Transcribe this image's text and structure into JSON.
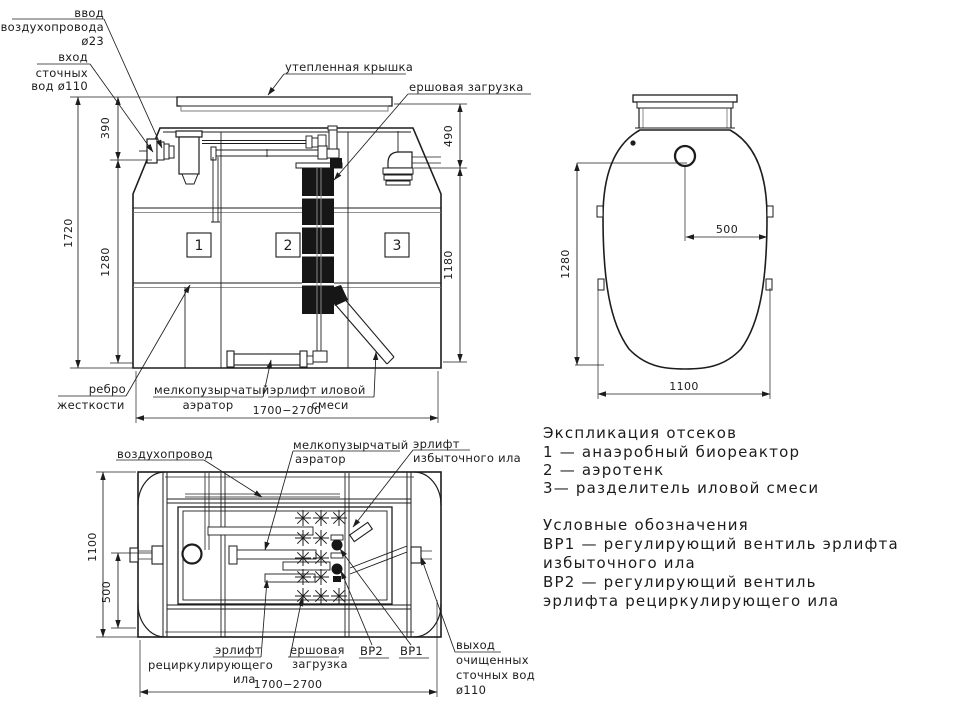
{
  "style": {
    "ink": "#1d1d1d",
    "background": "#ffffff"
  },
  "front_view": {
    "callouts": {
      "air_inlet": [
        "ввод",
        "воздухопровода",
        "ø23"
      ],
      "sewage_inlet": [
        "вход",
        "сточных",
        "вод ø110"
      ],
      "insulated_cover": "утепленная крышка",
      "brush_media": "ершовая загрузка",
      "stiffening_rib": [
        "ребро",
        "жесткости"
      ],
      "fine_bubble_aerator": [
        "мелкопузырчатый",
        "аэратор"
      ],
      "sludge_airlift": [
        "эрлифт иловой",
        "смеси"
      ]
    },
    "compartments": [
      "1",
      "2",
      "3"
    ],
    "dims": {
      "total_height": "1720",
      "inlet_depth": "390",
      "left_body_height": "1280",
      "cover_height": "490",
      "right_body_height": "1180",
      "length": "1700−2700"
    }
  },
  "side_view": {
    "dims": {
      "half_width": "500",
      "height": "1280",
      "width": "1100"
    }
  },
  "plan_view": {
    "callouts": {
      "air_duct": "воздухопровод",
      "fine_bubble_aerator": [
        "мелкопузырчатый",
        "аэратор"
      ],
      "excess_sludge_airlift": [
        "эрлифт",
        "избыточного ила"
      ],
      "recirculating_sludge_airlift": [
        "эрлифт",
        "рециркулирующего",
        "ила"
      ],
      "brush_media": [
        "ершовая",
        "загрузка"
      ],
      "valve2": "ВР2",
      "valve1": "ВР1",
      "outlet": [
        "выход",
        "очищенных",
        "сточных вод",
        "ø110"
      ]
    },
    "dims": {
      "width": "1100",
      "inlet_offset": "500",
      "length": "1700−2700"
    }
  },
  "legend": {
    "sections": [
      {
        "lines": [
          "Экспликация отсеков",
          "1 —  анаэробный биореактор",
          "2 —  аэротенк",
          "3—  разделитель иловой смеси"
        ]
      },
      {
        "lines": [
          "Условные обозначения",
          "ВР1 —  регулирующий вентиль эрлифта",
          "избыточного ила",
          "ВР2 —  регулирующий вентиль",
          "эрлифта рециркулирующего ила"
        ]
      }
    ]
  }
}
